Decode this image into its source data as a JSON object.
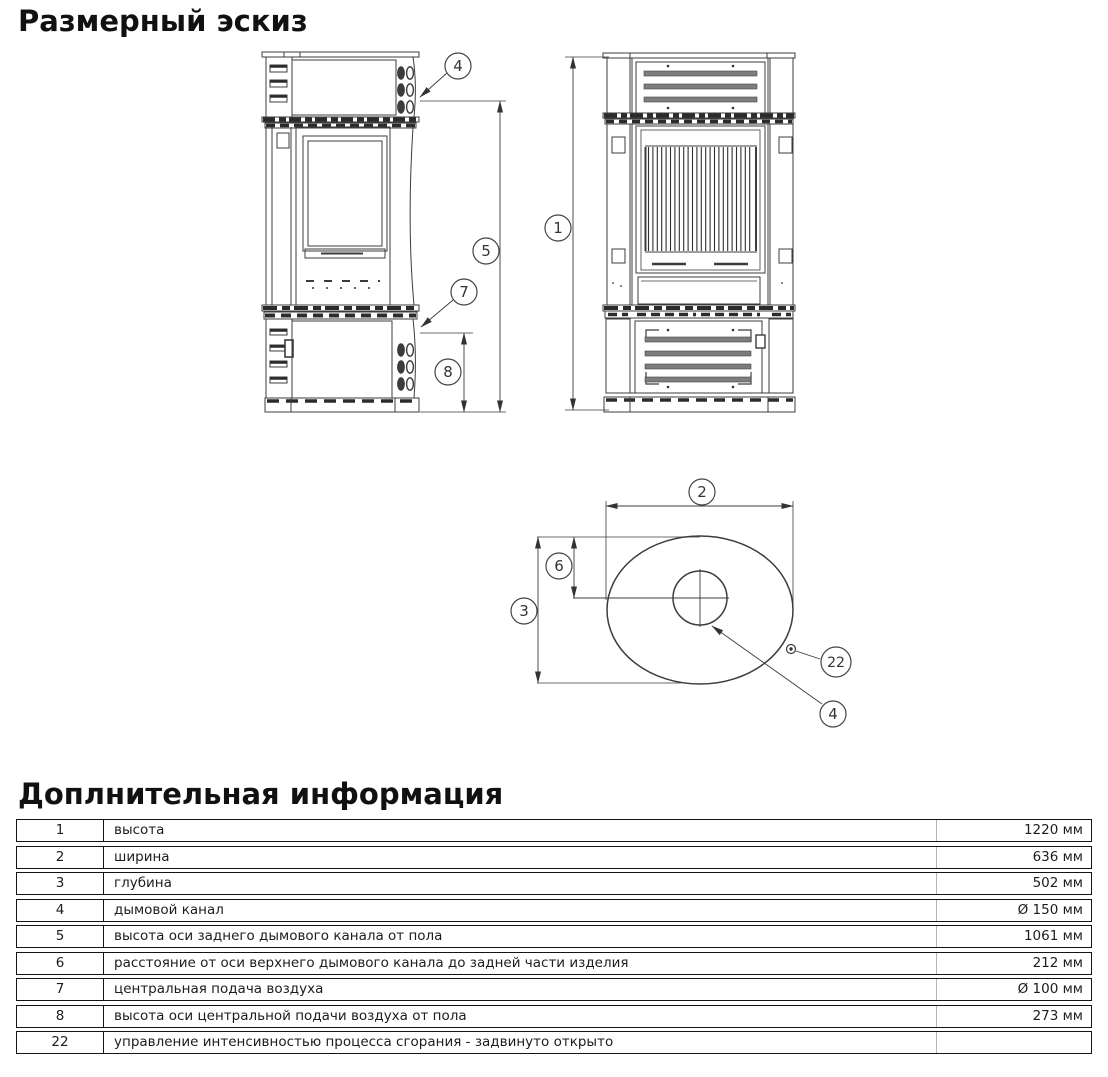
{
  "page": {
    "title": "Размерный эскиз",
    "info_title": "Доплнительная информация"
  },
  "diagram": {
    "callouts": {
      "n1": "1",
      "n2": "2",
      "n3": "3",
      "n4": "4",
      "n5": "5",
      "n6": "6",
      "n7": "7",
      "n8": "8",
      "n22": "22"
    }
  },
  "info_table": {
    "rows": [
      {
        "num": "1",
        "desc": "высота",
        "value": "1220 мм"
      },
      {
        "num": "2",
        "desc": "ширина",
        "value": "636 мм"
      },
      {
        "num": "3",
        "desc": "глубина",
        "value": "502 мм"
      },
      {
        "num": "4",
        "desc": "дымовой канал",
        "value": "Ø 150 мм"
      },
      {
        "num": "5",
        "desc": "высота оси заднего дымового канала от пола",
        "value": "1061 мм"
      },
      {
        "num": "6",
        "desc": "расстояние от оси верхнего дымового канала до задней части изделия",
        "value": "212 мм"
      },
      {
        "num": "7",
        "desc": "центральная подача воздуха",
        "value": "Ø 100 мм"
      },
      {
        "num": "8",
        "desc": "высота оси центральной подачи воздуха от пола",
        "value": "273 мм"
      },
      {
        "num": "22",
        "desc": "управление интенсивностью процесса сгорания - задвинуто открыто",
        "value": ""
      }
    ]
  }
}
